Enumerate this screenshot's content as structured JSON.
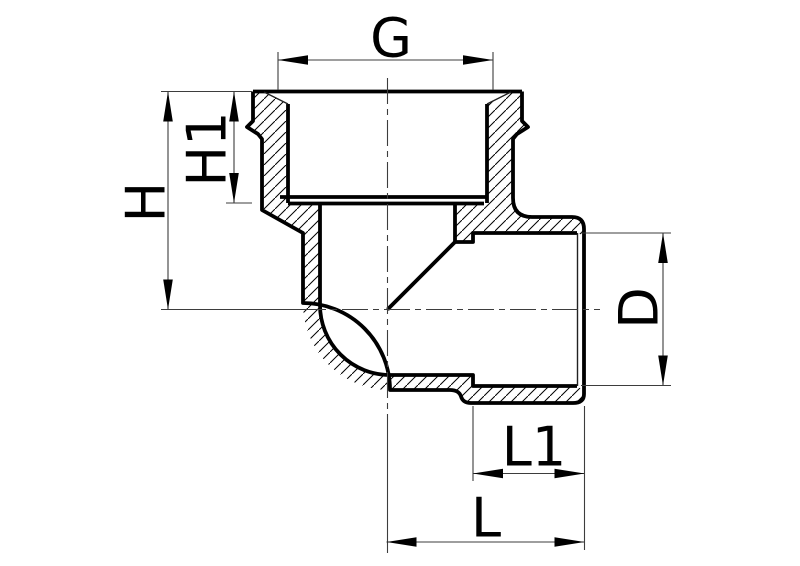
{
  "drawing": {
    "type": "technical-section-drawing",
    "subject": "90-degree pipe elbow fitting cross-section",
    "dimensions": {
      "g": {
        "label": "G"
      },
      "h1": {
        "label": "H1"
      },
      "h": {
        "label": "H"
      },
      "d": {
        "label": "D"
      },
      "l1": {
        "label": "L1"
      },
      "l": {
        "label": "L"
      }
    },
    "colors": {
      "line": "#000000",
      "thin_line": "#3d3d3d",
      "background": "#ffffff"
    }
  }
}
